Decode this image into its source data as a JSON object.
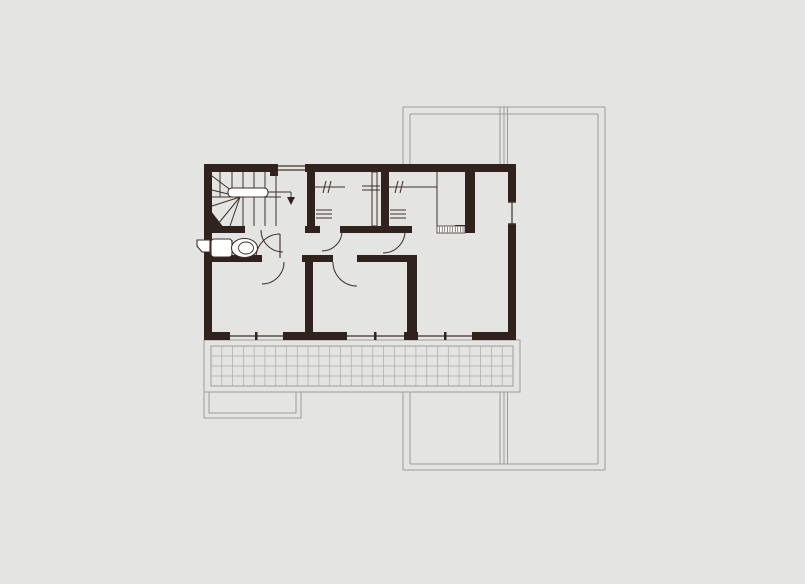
{
  "plan": {
    "canvas": {
      "width": 805,
      "height": 584
    },
    "colors": {
      "bg": "#e4e4e3",
      "wall": "#30231d",
      "line": "#3f2f28",
      "gray": "#9c9c99",
      "tile": "#ababa8",
      "white": "#ffffff"
    },
    "shapes": [
      {
        "n": "roof-outline-top-outer",
        "t": "line",
        "p": [
          403,
          107,
          605,
          107
        ],
        "s": "gray",
        "w": 1
      },
      {
        "n": "roof-outline-top-inner",
        "t": "line",
        "p": [
          410,
          114,
          598,
          114
        ],
        "s": "gray",
        "w": 1
      },
      {
        "n": "roof-outline-left-outer-upper",
        "t": "line",
        "p": [
          403,
          107,
          403,
          164
        ],
        "s": "gray",
        "w": 1
      },
      {
        "n": "roof-outline-left-inner-upper",
        "t": "line",
        "p": [
          410,
          114,
          410,
          164
        ],
        "s": "gray",
        "w": 1
      },
      {
        "n": "roof-outline-left-outer-lower",
        "t": "line",
        "p": [
          403,
          392,
          403,
          470
        ],
        "s": "gray",
        "w": 1
      },
      {
        "n": "roof-outline-left-inner-lower",
        "t": "line",
        "p": [
          410,
          392,
          410,
          464
        ],
        "s": "gray",
        "w": 1
      },
      {
        "n": "roof-outline-mid-1-upper",
        "t": "line",
        "p": [
          500,
          107,
          500,
          164
        ],
        "s": "gray",
        "w": 1
      },
      {
        "n": "roof-outline-mid-2-upper",
        "t": "line",
        "p": [
          504,
          107,
          504,
          164
        ],
        "s": "gray",
        "w": 1
      },
      {
        "n": "roof-outline-mid-3-upper",
        "t": "line",
        "p": [
          507.5,
          107,
          507.5,
          164
        ],
        "s": "gray",
        "w": 1
      },
      {
        "n": "roof-outline-mid-1-lower",
        "t": "line",
        "p": [
          500,
          392,
          500,
          464
        ],
        "s": "gray",
        "w": 1
      },
      {
        "n": "roof-outline-mid-2-lower",
        "t": "line",
        "p": [
          504,
          392,
          504,
          464
        ],
        "s": "gray",
        "w": 1
      },
      {
        "n": "roof-outline-mid-3-lower",
        "t": "line",
        "p": [
          507.5,
          392,
          507.5,
          464
        ],
        "s": "gray",
        "w": 1
      },
      {
        "n": "roof-outline-right-inner",
        "t": "line",
        "p": [
          598,
          114,
          598,
          464
        ],
        "s": "gray",
        "w": 1
      },
      {
        "n": "roof-outline-right-outer",
        "t": "line",
        "p": [
          605,
          107,
          605,
          470
        ],
        "s": "gray",
        "w": 1
      },
      {
        "n": "roof-outline-bottom-inner",
        "t": "line",
        "p": [
          410,
          464,
          598,
          464
        ],
        "s": "gray",
        "w": 1
      },
      {
        "n": "roof-outline-bottom-outer",
        "t": "line",
        "p": [
          403,
          470,
          605,
          470
        ],
        "s": "gray",
        "w": 1
      },
      {
        "n": "balcony-slab-outline",
        "t": "rect",
        "x": 204,
        "y": 340,
        "wd": 316,
        "h": 52,
        "s": "gray",
        "w": 1
      },
      {
        "n": "balcony-deck-outline",
        "t": "rect",
        "x": 211,
        "y": 346,
        "wd": 302,
        "h": 40,
        "s": "gray",
        "w": 1
      },
      {
        "n": "balcony-tile-grid",
        "t": "grid",
        "x": 211,
        "y": 346,
        "wd": 302,
        "h": 40,
        "cols": 28,
        "rows": 4,
        "s": "tile",
        "w": 0.7
      },
      {
        "n": "canopy-outline-outer",
        "t": "rect",
        "x": 204,
        "y": 392,
        "wd": 97,
        "h": 26,
        "s": "gray",
        "w": 1
      },
      {
        "n": "canopy-outline-inner",
        "t": "rect",
        "x": 209,
        "y": 392,
        "wd": 87,
        "h": 21,
        "s": "gray",
        "w": 1
      },
      {
        "n": "wall-top-left",
        "t": "rect",
        "x": 204,
        "y": 164,
        "wd": 74,
        "h": 8,
        "f": "wall"
      },
      {
        "n": "wall-top-main",
        "t": "rect",
        "x": 305,
        "y": 164,
        "wd": 211,
        "h": 8,
        "f": "wall"
      },
      {
        "n": "wall-top-window-stub",
        "t": "rect",
        "x": 270,
        "y": 164,
        "wd": 8,
        "h": 12,
        "f": "wall"
      },
      {
        "n": "wall-left",
        "t": "rect",
        "x": 204,
        "y": 164,
        "wd": 8,
        "h": 176,
        "f": "wall"
      },
      {
        "n": "wall-right-upper",
        "t": "rect",
        "x": 508,
        "y": 164,
        "wd": 8,
        "h": 38,
        "f": "wall"
      },
      {
        "n": "wall-right-lower",
        "t": "rect",
        "x": 508,
        "y": 224,
        "wd": 8,
        "h": 116,
        "f": "wall"
      },
      {
        "n": "wall-bottom-left",
        "t": "rect",
        "x": 204,
        "y": 332,
        "wd": 26,
        "h": 8,
        "f": "wall"
      },
      {
        "n": "wall-bottom-center",
        "t": "rect",
        "x": 283,
        "y": 332,
        "wd": 64,
        "h": 8,
        "f": "wall"
      },
      {
        "n": "wall-bottom-pier",
        "t": "rect",
        "x": 404,
        "y": 332,
        "wd": 14,
        "h": 8,
        "f": "wall"
      },
      {
        "n": "wall-bottom-right",
        "t": "rect",
        "x": 472,
        "y": 332,
        "wd": 44,
        "h": 8,
        "f": "wall"
      },
      {
        "n": "wall-closet1-left",
        "t": "rect",
        "x": 307,
        "y": 172,
        "wd": 8,
        "h": 54,
        "f": "wall"
      },
      {
        "n": "wall-stair-bottom",
        "t": "rect",
        "x": 204,
        "y": 226,
        "wd": 41,
        "h": 7,
        "f": "wall"
      },
      {
        "n": "wall-closet1-bottom-left",
        "t": "rect",
        "x": 305,
        "y": 226,
        "wd": 15,
        "h": 7,
        "f": "wall"
      },
      {
        "n": "wall-closets-bottom",
        "t": "rect",
        "x": 340,
        "y": 226,
        "wd": 72,
        "h": 7,
        "f": "wall"
      },
      {
        "n": "wall-closet-mid",
        "t": "rect",
        "x": 381,
        "y": 172,
        "wd": 8,
        "h": 61,
        "f": "wall"
      },
      {
        "n": "wall-closet2-right",
        "t": "rect",
        "x": 465,
        "y": 172,
        "wd": 10,
        "h": 60,
        "f": "wall"
      },
      {
        "n": "wall-closet2-cap",
        "t": "rect",
        "x": 455,
        "y": 225,
        "wd": 20,
        "h": 8,
        "f": "wall"
      },
      {
        "n": "wall-wc-bottom",
        "t": "rect",
        "x": 204,
        "y": 255,
        "wd": 46,
        "h": 7,
        "f": "wall"
      },
      {
        "n": "wall-wc-stub",
        "t": "rect",
        "x": 248,
        "y": 255,
        "wd": 14,
        "h": 7,
        "f": "wall"
      },
      {
        "n": "wall-hall-cap",
        "t": "rect",
        "x": 302,
        "y": 255,
        "wd": 31,
        "h": 7,
        "f": "wall"
      },
      {
        "n": "wall-hall-right",
        "t": "rect",
        "x": 357,
        "y": 255,
        "wd": 60,
        "h": 7,
        "f": "wall"
      },
      {
        "n": "wall-bedrooms-divider",
        "t": "rect",
        "x": 305,
        "y": 262,
        "wd": 8,
        "h": 70,
        "f": "wall"
      },
      {
        "n": "wall-bedroom-right-divider",
        "t": "rect",
        "x": 407,
        "y": 255,
        "wd": 10,
        "h": 77,
        "f": "wall"
      },
      {
        "n": "stair-corner-fill",
        "t": "poly",
        "pts": "204,202 204,233 228,233",
        "f": "wall"
      },
      {
        "n": "window-top-line-outer",
        "t": "line",
        "p": [
          277,
          166,
          305,
          166
        ],
        "s": "line",
        "w": 1.2
      },
      {
        "n": "window-top-line-inner",
        "t": "line",
        "p": [
          277,
          170,
          305,
          170
        ],
        "s": "line",
        "w": 1.2
      },
      {
        "n": "window-right-line",
        "t": "line",
        "p": [
          512,
          202,
          512,
          224
        ],
        "s": "line",
        "w": 1.2
      },
      {
        "n": "window-right-tick-top",
        "t": "line",
        "p": [
          508,
          202,
          516,
          202
        ],
        "s": "line",
        "w": 1.5
      },
      {
        "n": "window-right-tick-bottom",
        "t": "line",
        "p": [
          508,
          224,
          516,
          224
        ],
        "s": "line",
        "w": 1.5
      },
      {
        "n": "window-bottom-left-line",
        "t": "line",
        "p": [
          230,
          336,
          283,
          336
        ],
        "s": "line",
        "w": 1.2
      },
      {
        "n": "window-bottom-middle-line",
        "t": "line",
        "p": [
          347,
          336,
          404,
          336
        ],
        "s": "line",
        "w": 1.2
      },
      {
        "n": "window-bottom-right-line",
        "t": "line",
        "p": [
          418,
          336,
          472,
          336
        ],
        "s": "line",
        "w": 1.2
      },
      {
        "n": "window-bottom-left-tick",
        "t": "rect",
        "x": 255,
        "y": 332,
        "wd": 2.5,
        "h": 8,
        "f": "wall"
      },
      {
        "n": "window-bottom-middle-tick",
        "t": "rect",
        "x": 374,
        "y": 332,
        "wd": 2.5,
        "h": 8,
        "f": "wall"
      },
      {
        "n": "window-bottom-right-tick",
        "t": "rect",
        "x": 444,
        "y": 332,
        "wd": 2.5,
        "h": 8,
        "f": "wall"
      },
      {
        "n": "stair-tread-1",
        "t": "line",
        "p": [
          220,
          172,
          220,
          197
        ],
        "s": "line",
        "w": 1
      },
      {
        "n": "stair-tread-2",
        "t": "line",
        "p": [
          232,
          172,
          232,
          197
        ],
        "s": "line",
        "w": 1
      },
      {
        "n": "stair-tread-3",
        "t": "line",
        "p": [
          243,
          172,
          243,
          197
        ],
        "s": "line",
        "w": 1
      },
      {
        "n": "stair-tread-4",
        "t": "line",
        "p": [
          254,
          172,
          254,
          197
        ],
        "s": "line",
        "w": 1
      },
      {
        "n": "stair-tread-5",
        "t": "line",
        "p": [
          265,
          172,
          265,
          197
        ],
        "s": "line",
        "w": 1
      },
      {
        "n": "stair-tread-6",
        "t": "line",
        "p": [
          243,
          197,
          243,
          226
        ],
        "s": "line",
        "w": 1
      },
      {
        "n": "stair-tread-7",
        "t": "line",
        "p": [
          254,
          197,
          254,
          226
        ],
        "s": "line",
        "w": 1
      },
      {
        "n": "stair-tread-8",
        "t": "line",
        "p": [
          265,
          197,
          265,
          226
        ],
        "s": "line",
        "w": 1
      },
      {
        "n": "stair-edge-line",
        "t": "line",
        "p": [
          276,
          172,
          276,
          226
        ],
        "s": "line",
        "w": 1
      },
      {
        "n": "stair-landing-line",
        "t": "line",
        "p": [
          212,
          197,
          281,
          197
        ],
        "s": "line",
        "w": 1
      },
      {
        "n": "stair-winder-ray-1",
        "t": "line",
        "p": [
          240,
          197,
          212,
          176
        ],
        "s": "line",
        "w": 1
      },
      {
        "n": "stair-winder-ray-2",
        "t": "line",
        "p": [
          240,
          197,
          212,
          190
        ],
        "s": "line",
        "w": 1
      },
      {
        "n": "stair-winder-ray-3",
        "t": "line",
        "p": [
          240,
          197,
          212,
          206
        ],
        "s": "line",
        "w": 1
      },
      {
        "n": "stair-winder-ray-4",
        "t": "line",
        "p": [
          240,
          197,
          218,
          224
        ],
        "s": "line",
        "w": 1
      },
      {
        "n": "stair-winder-ray-5",
        "t": "line",
        "p": [
          240,
          197,
          230,
          226
        ],
        "s": "line",
        "w": 1
      },
      {
        "n": "stair-handrail",
        "t": "rect",
        "x": 228,
        "y": 188,
        "wd": 40,
        "h": 9,
        "rx": 4,
        "f": "white",
        "s": "line",
        "w": 1.1
      },
      {
        "n": "stair-direction-line",
        "t": "line",
        "p": [
          268,
          192,
          291,
          192
        ],
        "s": "line",
        "w": 1
      },
      {
        "n": "stair-direction-stem",
        "t": "line",
        "p": [
          291,
          192,
          291,
          197
        ],
        "s": "line",
        "w": 1
      },
      {
        "n": "stair-direction-arrow",
        "t": "poly",
        "pts": "287,197 295,197 291,205",
        "f": "wall"
      },
      {
        "n": "closet1-rod-line",
        "t": "line",
        "p": [
          315,
          187,
          345,
          187
        ],
        "s": "line",
        "w": 1
      },
      {
        "n": "closet1-rod-tick-1",
        "t": "line",
        "p": [
          326,
          181,
          323,
          193
        ],
        "s": "line",
        "w": 1
      },
      {
        "n": "closet1-rod-tick-2",
        "t": "line",
        "p": [
          331,
          181,
          328,
          193
        ],
        "s": "line",
        "w": 1
      },
      {
        "n": "closet1-shelf-mark-1",
        "t": "line",
        "p": [
          316,
          210,
          332,
          210
        ],
        "s": "line",
        "w": 1
      },
      {
        "n": "closet1-shelf-mark-2",
        "t": "line",
        "p": [
          316,
          214,
          332,
          214
        ],
        "s": "line",
        "w": 1
      },
      {
        "n": "closet1-shelf-mark-3",
        "t": "line",
        "p": [
          316,
          218,
          332,
          218
        ],
        "s": "line",
        "w": 1
      },
      {
        "n": "closet-divider-wall",
        "t": "rect",
        "x": 372,
        "y": 172,
        "wd": 5,
        "h": 54,
        "s": "line",
        "w": 1
      },
      {
        "n": "closet-divider-mark-1",
        "t": "line",
        "p": [
          362,
          186,
          380,
          186
        ],
        "s": "line",
        "w": 1
      },
      {
        "n": "closet-divider-mark-2",
        "t": "line",
        "p": [
          362,
          190,
          380,
          190
        ],
        "s": "line",
        "w": 1
      },
      {
        "n": "closet2-rod-line",
        "t": "line",
        "p": [
          389,
          187,
          437,
          187
        ],
        "s": "line",
        "w": 1
      },
      {
        "n": "closet2-rod-tick-1",
        "t": "line",
        "p": [
          398,
          181,
          395,
          193
        ],
        "s": "line",
        "w": 1
      },
      {
        "n": "closet2-rod-tick-2",
        "t": "line",
        "p": [
          403,
          181,
          400,
          193
        ],
        "s": "line",
        "w": 1
      },
      {
        "n": "closet2-shelf-mark-1",
        "t": "line",
        "p": [
          390,
          210,
          406,
          210
        ],
        "s": "line",
        "w": 1
      },
      {
        "n": "closet2-shelf-mark-2",
        "t": "line",
        "p": [
          390,
          214,
          406,
          214
        ],
        "s": "line",
        "w": 1
      },
      {
        "n": "closet2-shelf-mark-3",
        "t": "line",
        "p": [
          390,
          218,
          406,
          218
        ],
        "s": "line",
        "w": 1
      },
      {
        "n": "closet2-inner-line",
        "t": "line",
        "p": [
          437,
          172,
          437,
          226
        ],
        "s": "line",
        "w": 1
      },
      {
        "n": "closet2-shelf-hatch",
        "t": "hatch",
        "x": 437,
        "y": 226,
        "wd": 28,
        "h": 7,
        "step": 2.6,
        "f": "white",
        "s": "line",
        "w": 0.6
      },
      {
        "n": "toilet-cistern-spout",
        "t": "poly",
        "pts": "197,240 210,240 210,252 202,252 197,246",
        "f": "white",
        "s": "line",
        "w": 1.1
      },
      {
        "n": "toilet-tank",
        "t": "rect",
        "x": 211,
        "y": 239,
        "wd": 21,
        "h": 18,
        "rx": 3,
        "f": "white",
        "s": "line",
        "w": 1.1
      },
      {
        "n": "toilet-tank-divider",
        "t": "line",
        "p": [
          232,
          240,
          232,
          256
        ],
        "s": "line",
        "w": 1
      },
      {
        "n": "toilet-bowl",
        "t": "ellipse",
        "cx": 244.5,
        "cy": 248,
        "rx": 13,
        "ry": 9.5,
        "f": "white",
        "s": "line",
        "w": 1.1
      },
      {
        "n": "toilet-bowl-rim",
        "t": "ellipse",
        "cx": 246,
        "cy": 248,
        "rx": 7.5,
        "ry": 6,
        "f": "none",
        "s": "line",
        "w": 0.9
      },
      {
        "n": "wc-door-leaf",
        "t": "line",
        "p": [
          280,
          234,
          280,
          258
        ],
        "s": "line",
        "w": 1.1
      },
      {
        "n": "door-arc-stair",
        "t": "path",
        "d": "M 261,230 A 22 22 0 0 0 283,252",
        "s": "line",
        "w": 1
      },
      {
        "n": "door-arc-wc",
        "t": "path",
        "d": "M 280,234 A 24 24 0 0 0 256,258",
        "s": "line",
        "w": 1
      },
      {
        "n": "door-arc-bedroom-left",
        "t": "path",
        "d": "M 284,262 A 22 22 0 0 1 262,284",
        "s": "line",
        "w": 1
      },
      {
        "n": "door-arc-bedroom-middle",
        "t": "path",
        "d": "M 333,262 A 24 24 0 0 0 357,286",
        "s": "line",
        "w": 1
      },
      {
        "n": "door-arc-closet1",
        "t": "path",
        "d": "M 342,231 A 20 20 0 0 1 322,251",
        "s": "line",
        "w": 1
      },
      {
        "n": "door-arc-closet2",
        "t": "path",
        "d": "M 405,231 A 22 22 0 0 1 383,253",
        "s": "line",
        "w": 1
      }
    ]
  }
}
